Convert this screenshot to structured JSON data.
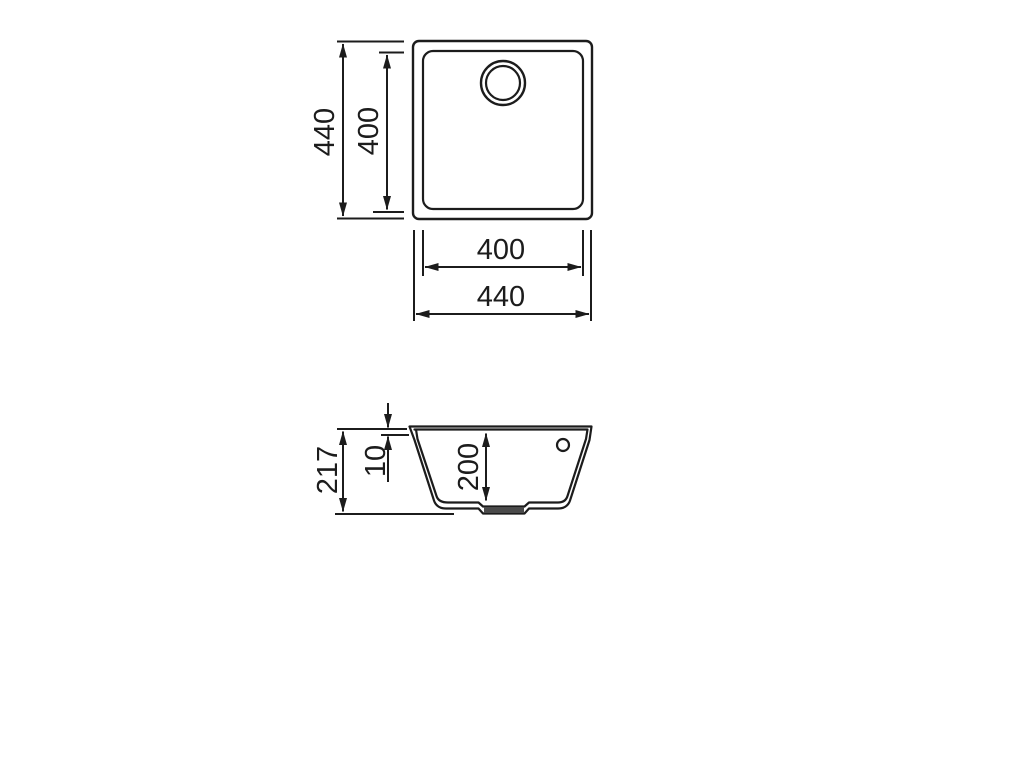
{
  "colors": {
    "line": "#1c1c1c",
    "drain_fill": "#4a4a4a",
    "background": "#ffffff"
  },
  "views": {
    "top_view": {
      "name": "sink-top-view",
      "dimensions": {
        "outer_height": "440",
        "inner_height": "400",
        "inner_width": "400",
        "outer_width": "440"
      }
    },
    "side_view": {
      "name": "sink-side-section-view",
      "dimensions": {
        "overall_depth": "217",
        "rim_height": "10",
        "bowl_depth": "200"
      }
    }
  }
}
